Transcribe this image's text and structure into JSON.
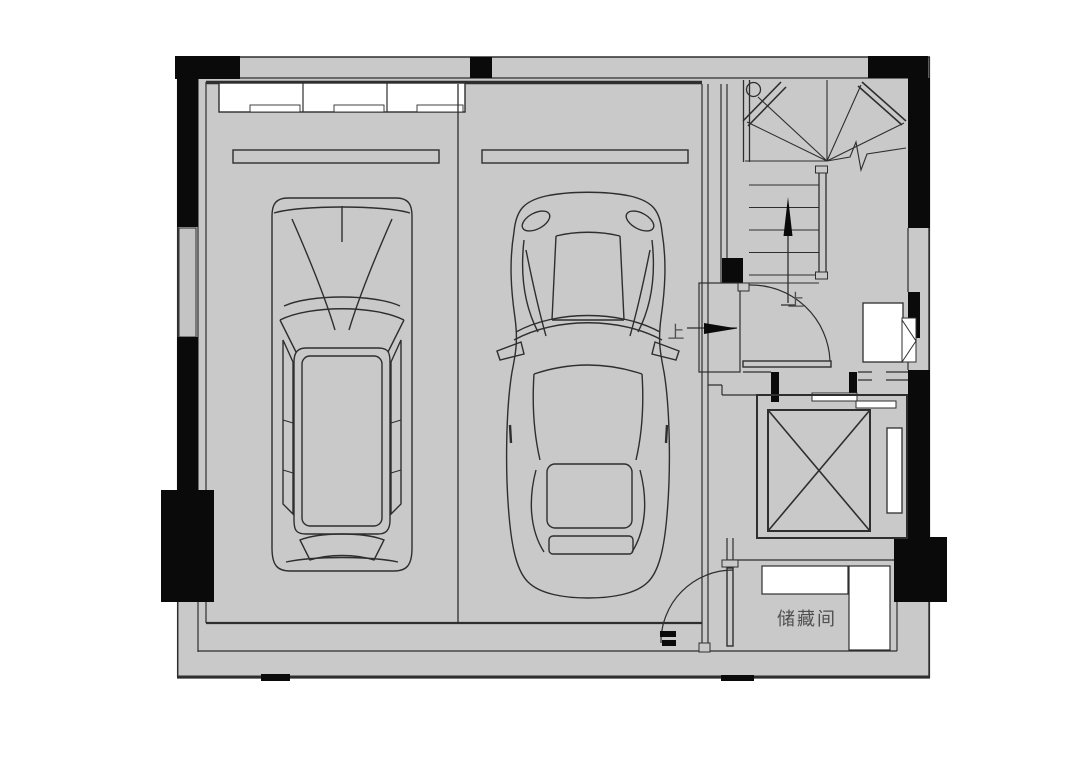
{
  "plan": {
    "labels": {
      "entry_up": "上",
      "door_up": "上",
      "storage_room": "储藏间"
    },
    "colors": {
      "page_bg": "#ffffff",
      "floor": "#c9c9c9",
      "window_gray": "#c4c4c4",
      "wall": "#0a0a0a",
      "line": "#2e2e2e",
      "white": "#ffffff",
      "text": "#4f4f4f"
    }
  }
}
